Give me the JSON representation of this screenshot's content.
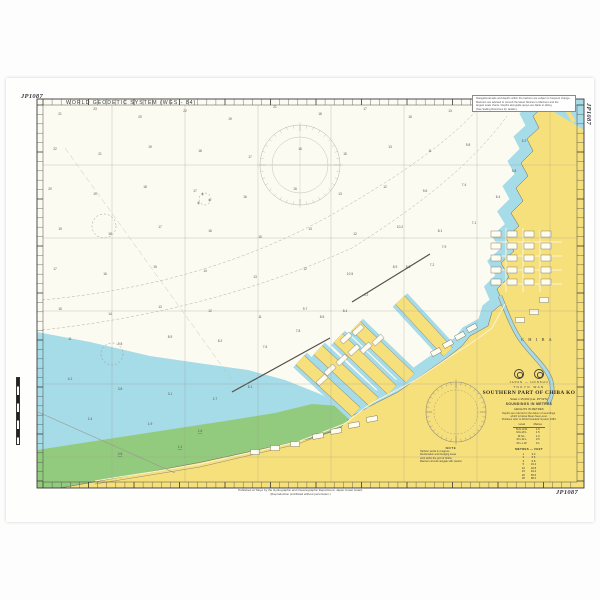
{
  "chart": {
    "number": "JP1087",
    "datum_note": "WORLD GEODETIC SYSTEM (WGS - 84)",
    "colors": {
      "land": "#F6E07C",
      "shallow_water": "#A6DBE8",
      "drying_area": "#93CB7E",
      "sea": "#FCFBF2",
      "frame": "#3a3a3a"
    }
  },
  "margin": {
    "note_box_lines": [
      "Navigational aids and depths within the harbour are subject to frequent change.",
      "Mariners are advised to consult the latest Notices to Mariners and the",
      "largest scale charts. Depths alongside quays are liable to silting.",
      "(See Sailing Directions for details.)"
    ],
    "attribution_line1": "Published at Tokyo by the Hydrographic and Oceanographic Department, Japan Coast Guard.",
    "attribution_line2": "(Reproduction prohibited without permission.)"
  },
  "labels": {
    "city": "C H I B A"
  },
  "title_block": {
    "nation_line": "JAPAN — HONSHU",
    "region_line": "TOKYO WAN",
    "title": "SOUTHERN PART OF CHIBA KO",
    "scale_line": "Scale 1:15,000 (Lat. 35°32′N)",
    "units_line": "SOUNDINGS IN METRES",
    "heights_line": "HEIGHTS IN METRES",
    "note_lines": [
      "Depths are referred to the datum of soundings,",
      "which is below Mean Sea Level.",
      "Positions refer to World Geodetic System 1984."
    ],
    "tide_table": {
      "title": "Tidal Levels above Datum",
      "col1": "Level",
      "col2": "Metres",
      "rows": [
        [
          "M.H.H.W.",
          "1.9"
        ],
        [
          "M.H.W.L.",
          "1.5"
        ],
        [
          "M.S.L.",
          "1.0"
        ],
        [
          "M.L.W.L.",
          "0.5"
        ],
        [
          "M.L.L.W.",
          "0.1"
        ]
      ]
    },
    "conversion_table": {
      "title": "METRES — FEET",
      "rows": [
        [
          "1",
          "3.3"
        ],
        [
          "2",
          "6.6"
        ],
        [
          "3",
          "9.8"
        ],
        [
          "5",
          "16.4"
        ],
        [
          "10",
          "32.8"
        ],
        [
          "15",
          "49.2"
        ],
        [
          "20",
          "65.6"
        ],
        [
          "30",
          "98.4"
        ]
      ]
    }
  },
  "notes_block": {
    "heading": "NOTE",
    "lines": [
      "Harbour works in progress.",
      "Reclamation and dredging areas",
      "exist within the port of Chiba.",
      "Mariners should navigate with caution."
    ]
  },
  "soundings": [
    [
      60,
      115,
      "21"
    ],
    [
      95,
      110,
      "23"
    ],
    [
      140,
      118,
      "20"
    ],
    [
      185,
      112,
      "22"
    ],
    [
      230,
      120,
      "19"
    ],
    [
      275,
      108,
      "21"
    ],
    [
      320,
      115,
      "18"
    ],
    [
      365,
      110,
      "17"
    ],
    [
      410,
      118,
      "15"
    ],
    [
      450,
      112,
      "13"
    ],
    [
      490,
      108,
      "11"
    ],
    [
      55,
      150,
      "22"
    ],
    [
      100,
      155,
      "21"
    ],
    [
      150,
      148,
      "19"
    ],
    [
      200,
      152,
      "18"
    ],
    [
      250,
      158,
      "17"
    ],
    [
      300,
      150,
      "16"
    ],
    [
      345,
      155,
      "15"
    ],
    [
      390,
      148,
      "13"
    ],
    [
      430,
      152,
      "11"
    ],
    [
      468,
      146,
      "9.8"
    ],
    [
      50,
      190,
      "20"
    ],
    [
      95,
      195,
      "19"
    ],
    [
      145,
      188,
      "18"
    ],
    [
      195,
      192,
      "17"
    ],
    [
      245,
      198,
      "16"
    ],
    [
      295,
      190,
      "15"
    ],
    [
      340,
      195,
      "13"
    ],
    [
      385,
      188,
      "12"
    ],
    [
      425,
      192,
      "9.6"
    ],
    [
      464,
      186,
      "7.4"
    ],
    [
      60,
      230,
      "19"
    ],
    [
      110,
      235,
      "18"
    ],
    [
      160,
      228,
      "17"
    ],
    [
      210,
      232,
      "16"
    ],
    [
      260,
      238,
      "15"
    ],
    [
      310,
      230,
      "13"
    ],
    [
      355,
      235,
      "12"
    ],
    [
      400,
      228,
      "10.2"
    ],
    [
      440,
      232,
      "8.1"
    ],
    [
      55,
      270,
      "17"
    ],
    [
      105,
      275,
      "16"
    ],
    [
      155,
      268,
      "15"
    ],
    [
      205,
      272,
      "14"
    ],
    [
      255,
      278,
      "13"
    ],
    [
      305,
      270,
      "12"
    ],
    [
      350,
      275,
      "10.5"
    ],
    [
      395,
      268,
      "8.9"
    ],
    [
      432,
      266,
      "7.2"
    ],
    [
      60,
      310,
      "15"
    ],
    [
      110,
      315,
      "14"
    ],
    [
      160,
      308,
      "13"
    ],
    [
      210,
      312,
      "12"
    ],
    [
      260,
      318,
      "11"
    ],
    [
      305,
      310,
      "9.7"
    ],
    [
      345,
      312,
      "8.4"
    ],
    [
      70,
      340,
      "11"
    ],
    [
      120,
      345,
      "9.8"
    ],
    [
      170,
      338,
      "8.9"
    ],
    [
      220,
      342,
      "8.2"
    ],
    [
      265,
      348,
      "7.6"
    ],
    [
      70,
      380,
      "4.2"
    ],
    [
      120,
      390,
      "3.8"
    ],
    [
      170,
      395,
      "3.1"
    ],
    [
      215,
      400,
      "2.7"
    ],
    [
      250,
      388,
      "5.1"
    ],
    [
      90,
      420,
      "2.4"
    ],
    [
      150,
      425,
      "1.9"
    ],
    [
      200,
      432,
      "1.6",
      1
    ],
    [
      120,
      455,
      "0.8",
      1
    ],
    [
      180,
      448,
      "1.2",
      1
    ],
    [
      298,
      332,
      "7.8"
    ],
    [
      322,
      318,
      "8.5"
    ],
    [
      366,
      296,
      "9.2"
    ],
    [
      408,
      268,
      "8.8"
    ],
    [
      444,
      248,
      "7.9"
    ],
    [
      474,
      224,
      "7.1"
    ],
    [
      498,
      198,
      "6.4"
    ],
    [
      514,
      172,
      "5.8"
    ],
    [
      524,
      142,
      "5.2"
    ],
    [
      558,
      110,
      "4.1"
    ]
  ]
}
